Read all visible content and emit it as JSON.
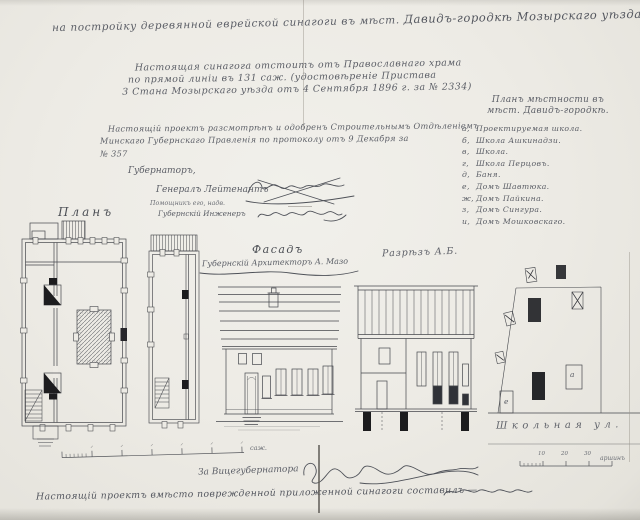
{
  "document": {
    "title_part1": "на постройку деревянной еврейской синагоги въ мѣст. ",
    "title_part2": "Давидъ-городкѣ Мозырскаго уѣзда.",
    "certificate": {
      "line1": "Настоящая синагога отстоитъ отъ Православнаго храма",
      "line2": "по прямой линіи въ 131 саж. (удостовѣреніе Пристава",
      "line3": "3 Стана Мозырскаго уѣзда отъ 4 Сентября 1896 г. за № 2334)"
    },
    "approval": {
      "line1": "Настоящій проектъ разсмотрѣнъ и одобренъ Строительнымъ Отдѣленіемъ",
      "line2": "Минскаго Губернскаго Правленія по протоколу отъ 9 Декабря за",
      "line3": "№ 357",
      "governor_title": "Губернаторъ,",
      "governor_rank": "Генералъ Лейтенантъ"
    },
    "legend": {
      "title_line1": "Планъ мѣстности въ",
      "title_line2": "мѣст. Давидъ-городкѣ.",
      "items": [
        {
          "key": "а,",
          "label": "Проектируемая школа."
        },
        {
          "key": "б,",
          "label": "Школа Ашкинадзи."
        },
        {
          "key": "в,",
          "label": "Школа."
        },
        {
          "key": "г,",
          "label": "Школа Перцовъ."
        },
        {
          "key": "д,",
          "label": "Баня."
        },
        {
          "key": "е,",
          "label": "Домъ Шавтюка."
        },
        {
          "key": "ж,",
          "label": "Домъ Пайкина."
        },
        {
          "key": "з,",
          "label": "Домъ Сингура."
        },
        {
          "key": "и,",
          "label": "Домъ Мошковскаго."
        }
      ]
    },
    "drawings": {
      "plan_label": "Планъ",
      "plan2_note1": "Помощникъ его, надв.",
      "plan2_note2": "Губернскій Инженеръ",
      "facade_label": "Фасадъ",
      "facade_architect": "Губернскій Архитекторъ А. Мазо",
      "section_label": "Разрѣзъ А.Б.",
      "siteplan_street": "Школьная ул.",
      "siteplan_building_a": "а",
      "siteplan_building_e": "е"
    },
    "scales": {
      "main_unit": "саж.",
      "site_unit": "аршинъ",
      "site_ticks": [
        "10",
        "20",
        "30"
      ]
    },
    "footer": {
      "vice_governor": "За Вицегубернатора",
      "note": "Настоящій проектъ вмѣсто поврежденной приложенной синагоги составилъ —"
    },
    "colors": {
      "paper": "#edebe5",
      "ink_handwriting": "#5b5e66",
      "ink_drawing": "#45474c",
      "ink_dark": "#1c1c1e"
    }
  }
}
